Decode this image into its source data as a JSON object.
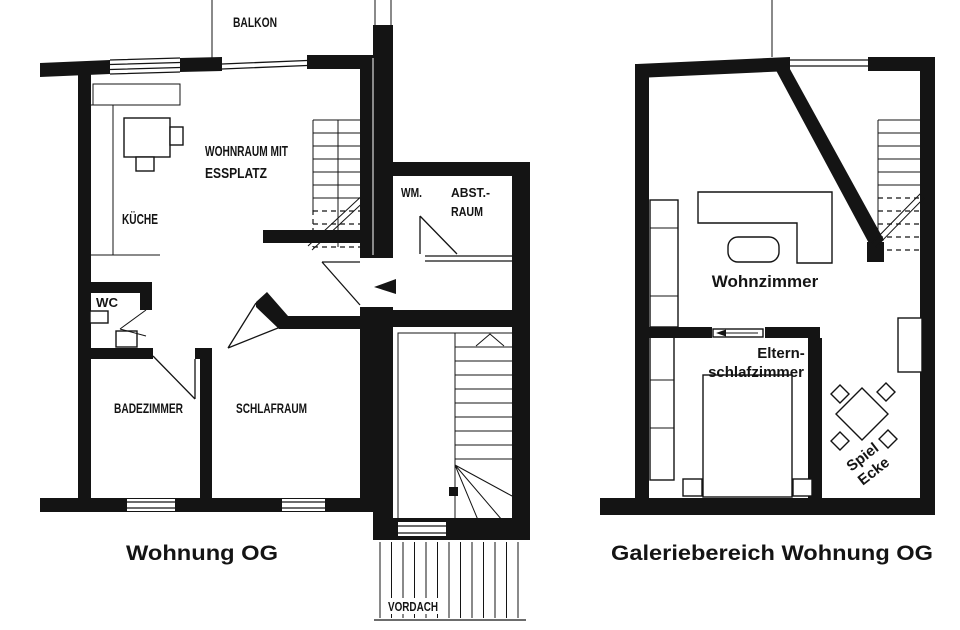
{
  "document": {
    "type": "architectural floor plan, black ink scan on white paper"
  },
  "colors": {
    "ink": "#141414",
    "paper": "#ffffff"
  },
  "left_plan": {
    "caption": "Wohnung OG",
    "labels": {
      "balkon": "BALKON",
      "wohnraum_line1": "WOHNRAUM MIT",
      "wohnraum_line2": "ESSPLATZ",
      "kueche": "KÜCHE",
      "wc": "WC",
      "badezimmer": "BADEZIMMER",
      "schlafraum": "SCHLAFRAUM",
      "wm": "WM.",
      "abstraum_line1": "ABST.-",
      "abstraum_line2": "RAUM",
      "vordach": "VORDACH"
    }
  },
  "right_plan": {
    "caption": "Galeriebereich Wohnung OG",
    "labels": {
      "wohnzimmer": "Wohnzimmer",
      "eltern_line1": "Eltern-",
      "eltern_line2": "schlafzimmer",
      "spielecke_line1": "Spiel",
      "spielecke_line2": "Ecke"
    }
  }
}
